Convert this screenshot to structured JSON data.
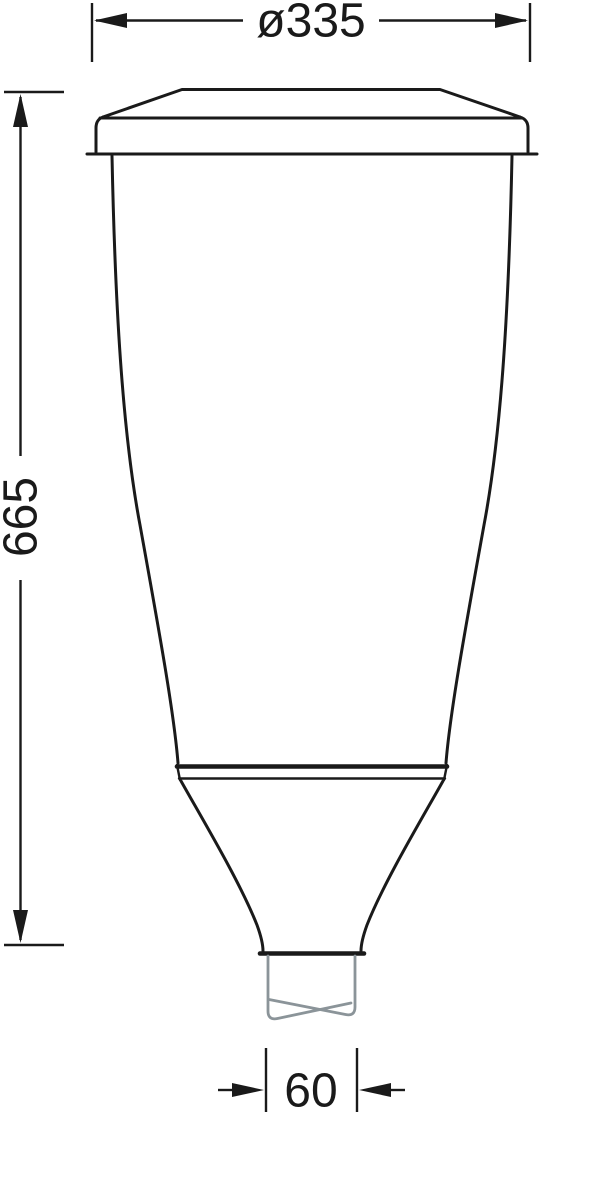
{
  "drawing": {
    "dimensions": {
      "top_diameter": "ø335",
      "height": "665",
      "outlet_width": "60"
    },
    "colors": {
      "outline": "#1a1a1a",
      "dimension": "#1a1a1a",
      "tube_break": "#8b9499",
      "background": "#ffffff"
    }
  }
}
